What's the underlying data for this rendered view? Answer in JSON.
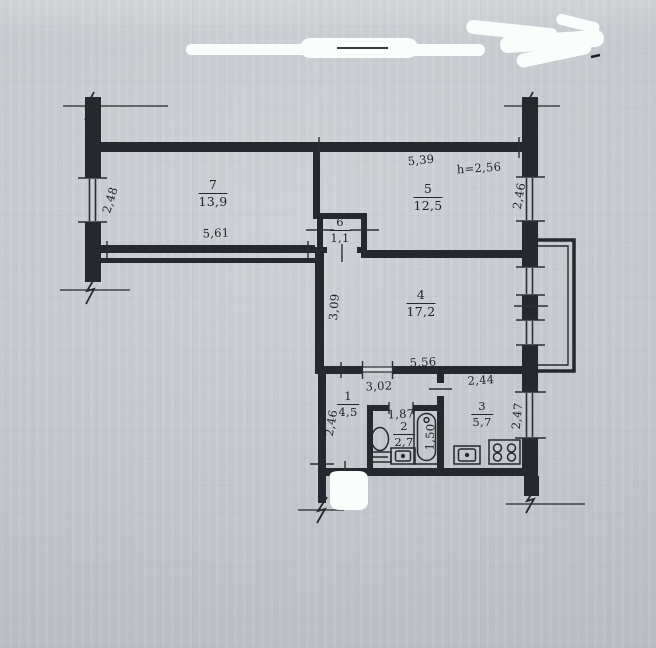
{
  "document_kind": "apartment-floor-plan-scan",
  "colors": {
    "paper": "#c8cbd1",
    "ink": "#26282d",
    "redaction": "#fbfcfc"
  },
  "rooms": {
    "room7": {
      "number": "7",
      "area": "13,9"
    },
    "room5": {
      "number": "5",
      "area": "12,5"
    },
    "room6": {
      "number": "6",
      "area": "1,1"
    },
    "room4": {
      "number": "4",
      "area": "17,2"
    },
    "room1": {
      "number": "1",
      "area": "4,5"
    },
    "room2": {
      "number": "2",
      "area": "2,7"
    },
    "room3": {
      "number": "3",
      "area": "5,7"
    }
  },
  "dimensions": {
    "room7_width": "5,61",
    "room7_window_height": "2,48",
    "room5_width": "5,39",
    "ceiling_height": "h=2,56",
    "room5_window_height": "2,46",
    "room4_height": "3,09",
    "room4_width": "5,56",
    "hall_width": "3,02",
    "kitchen_width": "2,44",
    "hall_height": "2,46",
    "bathroom_width": "1,87",
    "bathroom_height": "1,50",
    "kitchen_height": "2,47"
  }
}
